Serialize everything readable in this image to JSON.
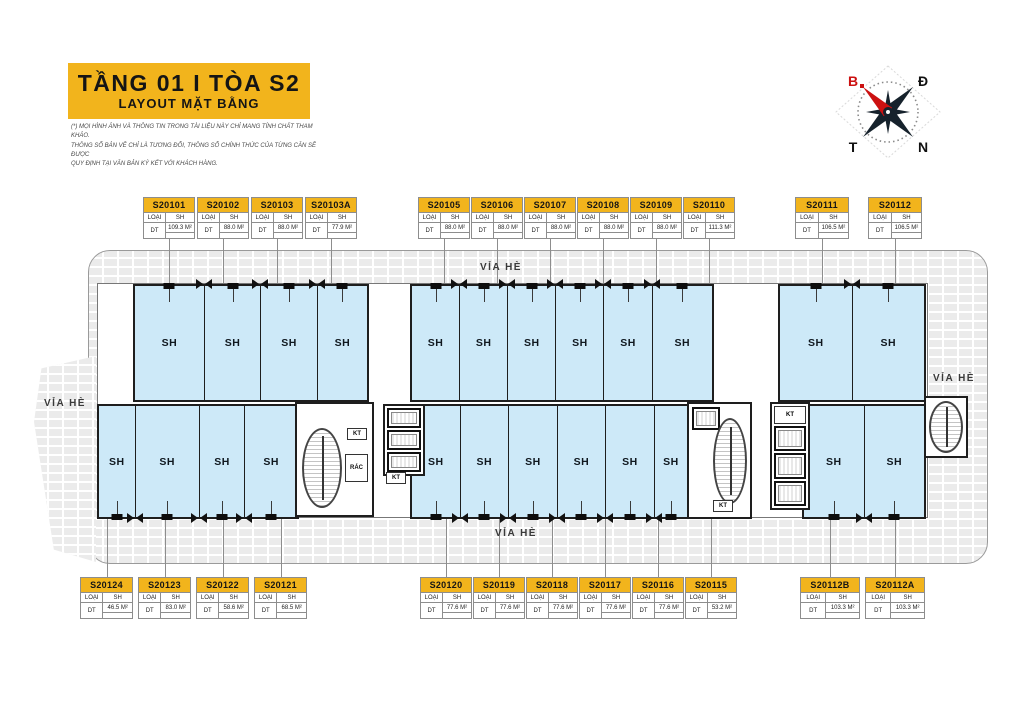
{
  "title": {
    "line1": "TẦNG 01 I TÒA S2",
    "line2": "LAYOUT MẶT BẰNG"
  },
  "disclaimer": {
    "line1": "(*) MỌI HÌNH ẢNH VÀ THÔNG TIN TRONG TÀI LIỆU NÀY CHỈ MANG TÍNH CHẤT THAM KHẢO.",
    "line2": "THÔNG SỐ BẢN VẼ CHỈ LÀ TƯƠNG ĐỐI, THÔNG SỐ CHÍNH THỨC CỦA TỪNG CĂN SẼ ĐƯỢC",
    "line3": "QUY ĐỊNH TẠI VĂN BẢN KÝ KẾT VỚI KHÁCH HÀNG."
  },
  "compass": {
    "north": "B",
    "east": "Đ",
    "west": "T",
    "south": "N"
  },
  "plan_labels": {
    "sidewalk": "VỈA HÈ",
    "room": "SH",
    "kt": "KT",
    "rac": "RÁC"
  },
  "legend": {
    "type_key": "LOẠI",
    "area_key": "DT"
  },
  "colors": {
    "brand_yellow": "#F2B41C",
    "room_blue": "#CDE9F8",
    "wall": "#1E1E1E",
    "sidewalk": "#EBEBEB",
    "compass_red": "#CC1111"
  },
  "unit_labels": {
    "top": [
      {
        "x": 143,
        "pitch": 54,
        "card_w": 52,
        "cards": [
          {
            "code": "S20101",
            "type": "SH",
            "area": "109.3 M²"
          },
          {
            "code": "S20102",
            "type": "SH",
            "area": "88.0 M²"
          },
          {
            "code": "S20103",
            "type": "SH",
            "area": "88.0 M²"
          },
          {
            "code": "S20103A",
            "type": "SH",
            "area": "77.9 M²"
          }
        ]
      },
      {
        "x": 418,
        "pitch": 53,
        "card_w": 52,
        "cards": [
          {
            "code": "S20105",
            "type": "SH",
            "area": "88.0 M²"
          },
          {
            "code": "S20106",
            "type": "SH",
            "area": "88.0 M²"
          },
          {
            "code": "S20107",
            "type": "SH",
            "area": "88.0 M²"
          },
          {
            "code": "S20108",
            "type": "SH",
            "area": "88.0 M²"
          },
          {
            "code": "S20109",
            "type": "SH",
            "area": "88.0 M²"
          },
          {
            "code": "S20110",
            "type": "SH",
            "area": "111.3 M²"
          }
        ]
      },
      {
        "x": 795,
        "pitch": 73,
        "card_w": 54,
        "cards": [
          {
            "code": "S20111",
            "type": "SH",
            "area": "106.5 M²"
          },
          {
            "code": "S20112",
            "type": "SH",
            "area": "106.5 M²"
          }
        ]
      }
    ],
    "bottom": [
      {
        "x": 80,
        "pitch": 58,
        "card_w": 53,
        "cards": [
          {
            "code": "S20124",
            "type": "SH",
            "area": "46.5 M²"
          },
          {
            "code": "S20123",
            "type": "SH",
            "area": "83.0 M²"
          },
          {
            "code": "S20122",
            "type": "SH",
            "area": "58.6 M²"
          },
          {
            "code": "S20121",
            "type": "SH",
            "area": "68.5 M²"
          }
        ]
      },
      {
        "x": 420,
        "pitch": 53,
        "card_w": 52,
        "cards": [
          {
            "code": "S20120",
            "type": "SH",
            "area": "77.6 M²"
          },
          {
            "code": "S20119",
            "type": "SH",
            "area": "77.6 M²"
          },
          {
            "code": "S20118",
            "type": "SH",
            "area": "77.6 M²"
          },
          {
            "code": "S20117",
            "type": "SH",
            "area": "77.6 M²"
          },
          {
            "code": "S20116",
            "type": "SH",
            "area": "77.6 M²"
          },
          {
            "code": "S20115",
            "type": "SH",
            "area": "53.2 M²"
          }
        ]
      },
      {
        "x": 800,
        "pitch": 65,
        "card_w": 60,
        "cards": [
          {
            "code": "S20112B",
            "type": "SH",
            "area": "103.3 M²"
          },
          {
            "code": "S20112A",
            "type": "SH",
            "area": "103.3 M²"
          }
        ]
      }
    ]
  },
  "plan": {
    "blocks": [
      {
        "name": "block-top-left",
        "x": 133,
        "y": 284,
        "w": 232,
        "h": 114,
        "side": "top",
        "rooms": [
          109,
          88,
          88,
          78
        ]
      },
      {
        "name": "block-top-mid",
        "x": 410,
        "y": 284,
        "w": 300,
        "h": 114,
        "side": "top",
        "rooms": [
          88,
          88,
          88,
          88,
          88,
          111
        ]
      },
      {
        "name": "block-top-right",
        "x": 778,
        "y": 284,
        "w": 144,
        "h": 114,
        "side": "top",
        "rooms": [
          106,
          106
        ]
      },
      {
        "name": "block-bottom-left",
        "x": 97,
        "y": 404,
        "w": 198,
        "h": 111,
        "side": "bottom",
        "rooms": [
          47,
          83,
          59,
          68
        ]
      },
      {
        "name": "block-bottom-mid",
        "x": 410,
        "y": 404,
        "w": 275,
        "h": 111,
        "side": "bottom",
        "rooms": [
          78,
          78,
          78,
          78,
          78,
          53
        ]
      },
      {
        "name": "block-bottom-right",
        "x": 802,
        "y": 404,
        "w": 120,
        "h": 111,
        "side": "bottom",
        "rooms": [
          103,
          103
        ]
      }
    ]
  }
}
